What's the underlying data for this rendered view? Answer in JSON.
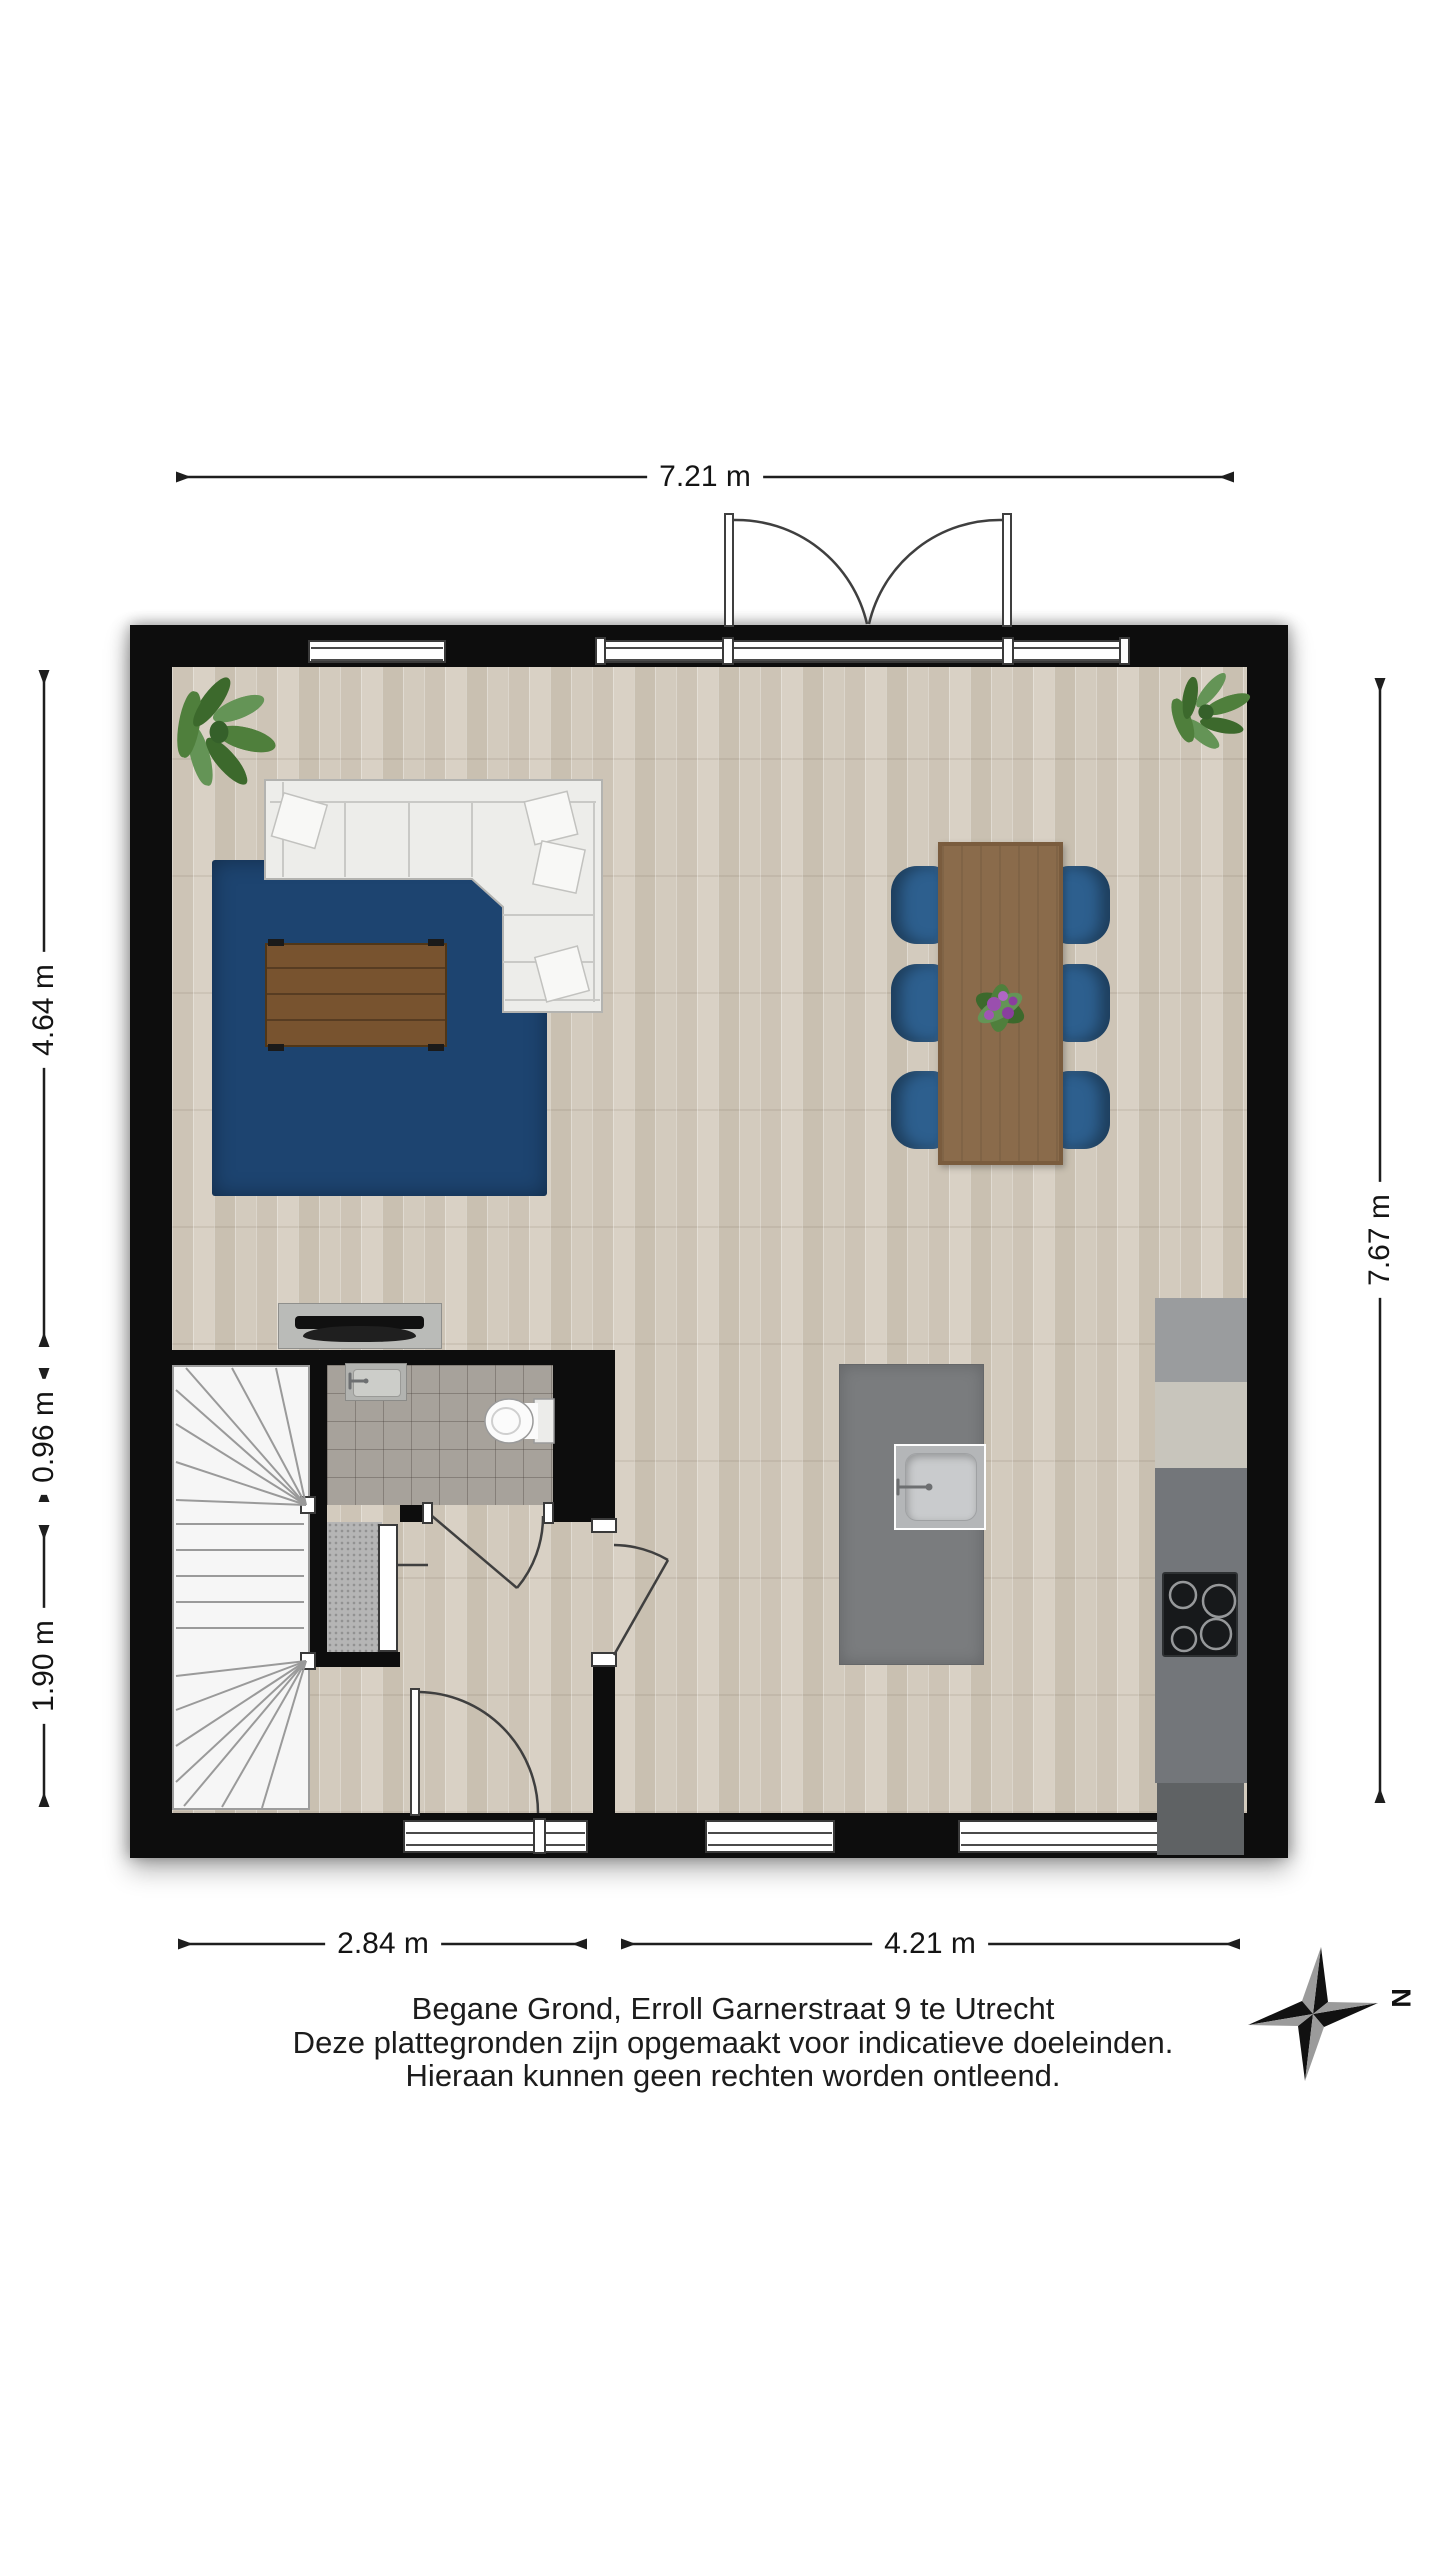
{
  "title_block": {
    "line1": "Begane Grond, Erroll Garnerstraat 9 te Utrecht",
    "line2": "Deze plattegronden zijn opgemaakt voor indicatieve doeleinden.",
    "line3": "Hieraan kunnen geen rechten worden ontleend."
  },
  "dimensions": {
    "top_width": "7.21 m",
    "left_living_height": "4.64 m",
    "left_toilet_height": "0.96 m",
    "left_hall_height": "1.90 m",
    "right_height": "7.67 m",
    "bottom_left_width": "2.84 m",
    "bottom_right_width": "4.21 m"
  },
  "compass": {
    "label": "N"
  },
  "colors": {
    "wall": "#0d0d0d",
    "floor": "#d4ccc0",
    "floor_stripe": "#c9c0b1",
    "tile": "#a7a29b",
    "stairs": "#f6f6f6",
    "rug": "#1d4470",
    "sofa": "#ededea",
    "chair": "#2d5f8e",
    "dining_table": "#8a6b4b",
    "coffee_table": "#78532f",
    "island": "#7a7c7e",
    "counter_gray": "#9a9c9e",
    "counter_beige": "#c8c5bc",
    "counter_dark": "#73767a",
    "cooktop": "#17191b",
    "plant": "#4f7f3c"
  }
}
